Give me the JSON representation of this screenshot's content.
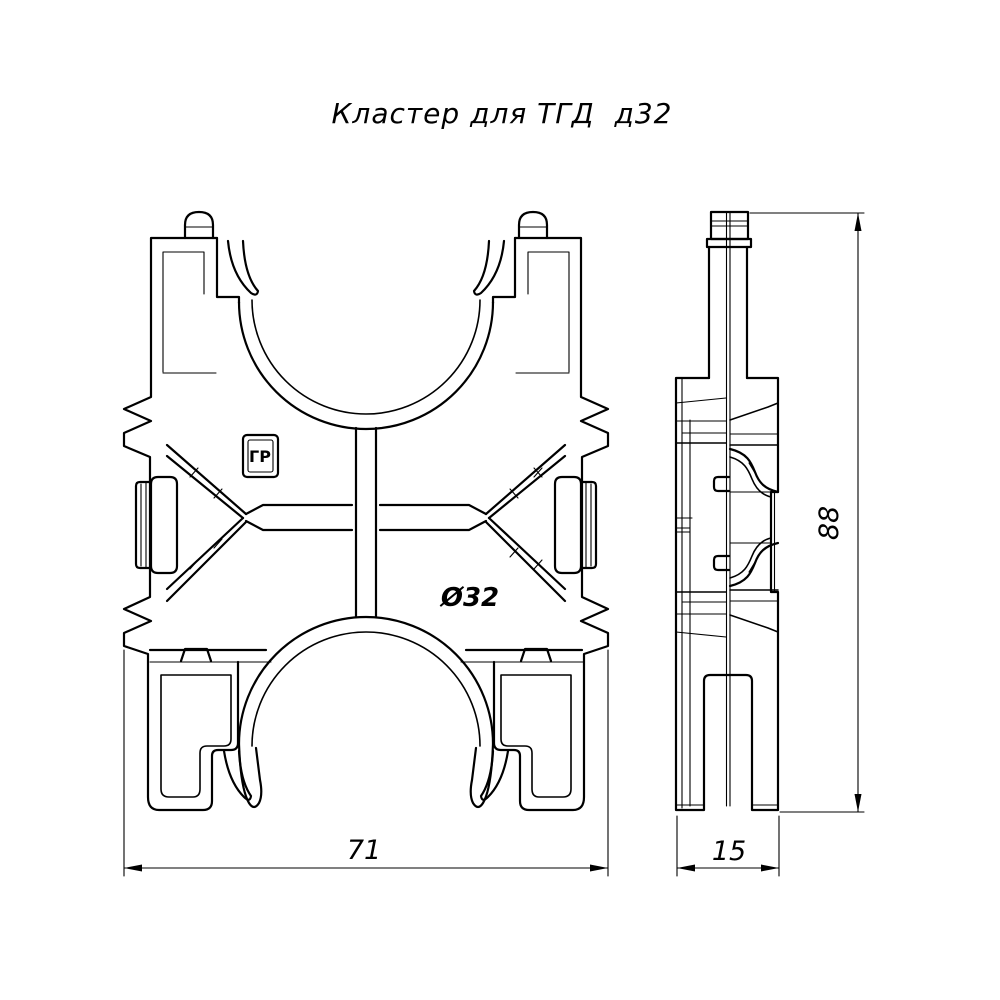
{
  "drawing": {
    "title": "Кластер для ТГД  д32",
    "labels": {
      "diameter": "Ø32",
      "logo": "ГР"
    },
    "dimensions": {
      "front_width": "71",
      "side_width": "15",
      "height": "88"
    },
    "colors": {
      "line": "#000000",
      "background": "#ffffff"
    }
  }
}
